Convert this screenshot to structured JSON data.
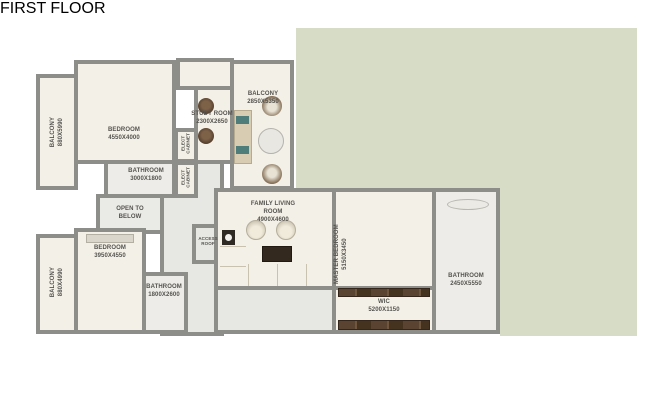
{
  "title": "FIRST FLOOR",
  "plan": {
    "rooms": {
      "balcony_tl": {
        "name": "BALCONY",
        "dims": "880X5990"
      },
      "bedroom1": {
        "name": "BEDROOM",
        "dims": "4550X4000"
      },
      "bathroom1": {
        "name": "BATHROOM",
        "dims": "3000X1800"
      },
      "elect_cabinet1": {
        "name": "ELECT CABINET"
      },
      "elect_cabinet2": {
        "name": "ELECT CABINET"
      },
      "study": {
        "name": "STUDY ROOM",
        "dims": "2300X2650"
      },
      "balcony_top": {
        "name": "BALCONY",
        "dims": "2850X5350"
      },
      "open_to_below": {
        "name": "OPEN TO BELOW"
      },
      "access_roof": {
        "name": "ACCESS ROOF"
      },
      "family_living": {
        "name": "FAMILY LIVING ROOM",
        "dims": "4900X4600"
      },
      "balcony_bl": {
        "name": "BALCONY",
        "dims": "880X4990"
      },
      "bedroom2": {
        "name": "BEDROOM",
        "dims": "3950X4550"
      },
      "bathroom2": {
        "name": "BATHROOM",
        "dims": "1800X2600"
      },
      "master_bedroom": {
        "name": "MASTER BEDROOM",
        "dims": "5150X3450"
      },
      "wic": {
        "name": "WIC",
        "dims": "5200X1150"
      },
      "master_bath": {
        "name": "BATHROOM",
        "dims": "2450X5550"
      }
    },
    "colors": {
      "garden": "#d7dcc6",
      "wall": "#8d8d89",
      "room_fill": "#f3f0e8",
      "wood": "#5a4330",
      "rug": "#8b7663"
    }
  }
}
